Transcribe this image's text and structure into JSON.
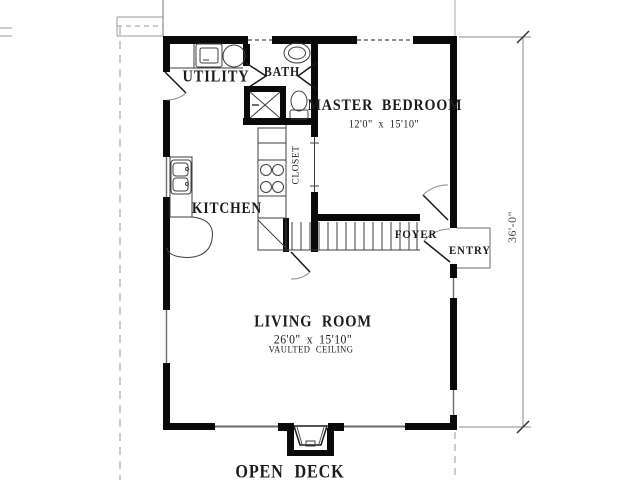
{
  "plan": {
    "title_context": "single-level house floor plan",
    "rooms": {
      "utility": {
        "label": "UTILITY"
      },
      "bath": {
        "label": "BATH"
      },
      "master_bedroom": {
        "label": "MASTER BEDROOM",
        "dimensions": "12'0\" x 15'10\""
      },
      "kitchen": {
        "label": "KITCHEN"
      },
      "closet": {
        "label": "CLOSET"
      },
      "foyer": {
        "label": "FOYER"
      },
      "entry": {
        "label": "ENTRY"
      },
      "living_room": {
        "label": "LIVING ROOM",
        "dimensions": "26'0\" x 15'10\"",
        "note": "VAULTED CEILING"
      },
      "open_deck": {
        "label": "OPEN DECK"
      }
    },
    "dimensions": {
      "overall_depth": "36'-0\""
    },
    "fixtures": [
      "washer",
      "dryer",
      "bath-sink",
      "shower",
      "toilet",
      "kitchen-sink",
      "range-burners",
      "dishwasher",
      "stairs",
      "fireplace"
    ],
    "colors": {
      "wall": "#0a0a0a",
      "thin_line": "#3f3f3f",
      "arc_line": "#707070",
      "site_line": "#9a9a9a",
      "background": "#ffffff",
      "text": "#1c1c1c"
    }
  }
}
